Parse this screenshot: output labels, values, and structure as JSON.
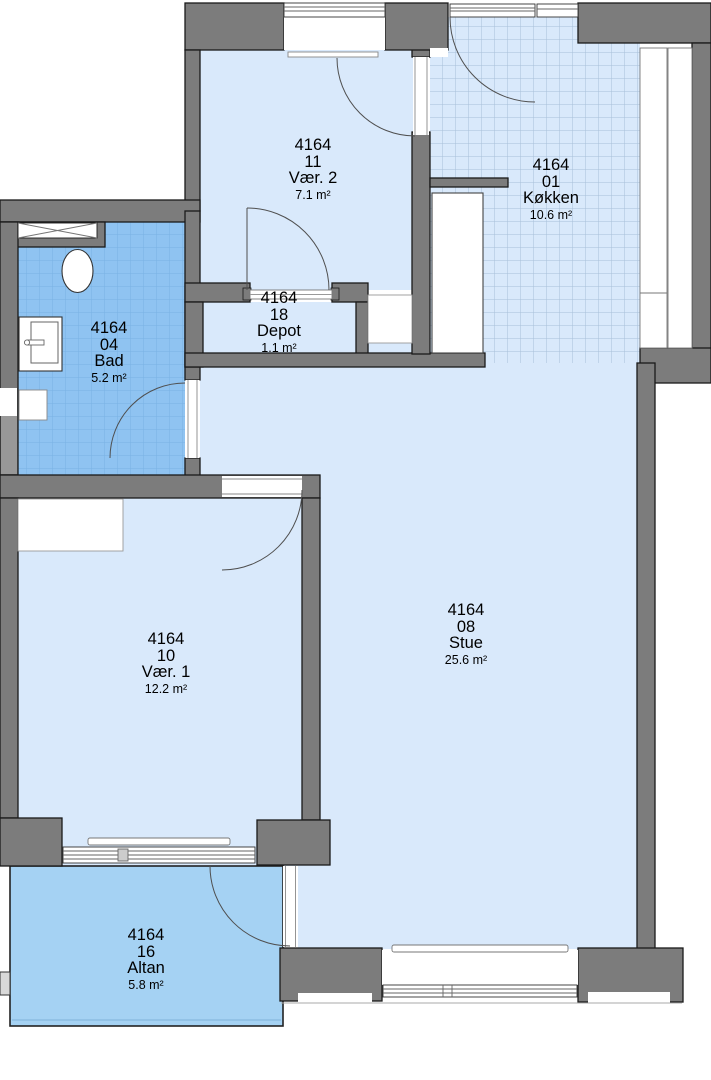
{
  "plan": {
    "project_code": "4164",
    "area_unit": "m²",
    "rooms": [
      {
        "id": "vaer2",
        "code": "4164",
        "number": "11",
        "name": "Vær. 2",
        "area": "7.1 m²"
      },
      {
        "id": "koekken",
        "code": "4164",
        "number": "01",
        "name": "Køkken",
        "area": "10.6 m²"
      },
      {
        "id": "depot",
        "code": "4164",
        "number": "18",
        "name": "Depot",
        "area": "1.1 m²"
      },
      {
        "id": "bad",
        "code": "4164",
        "number": "04",
        "name": "Bad",
        "area": "5.2 m²"
      },
      {
        "id": "stue",
        "code": "4164",
        "number": "08",
        "name": "Stue",
        "area": "25.6 m²"
      },
      {
        "id": "vaer1",
        "code": "4164",
        "number": "10",
        "name": "Vær. 1",
        "area": "12.2 m²"
      },
      {
        "id": "altan",
        "code": "4164",
        "number": "16",
        "name": "Altan",
        "area": "5.8 m²"
      }
    ],
    "colors": {
      "wall": "#7c7c7c",
      "wall_light": "#989898",
      "outline": "#1a1a1a",
      "floor": "#d9e9fb",
      "bad_floor": "#8fc3f1",
      "altan_floor": "#a5d2f3",
      "tile_grid_light": "#a8bfd8",
      "tile_grid_dark": "#79b2e4",
      "door_arc": "#4f4f4f"
    }
  }
}
